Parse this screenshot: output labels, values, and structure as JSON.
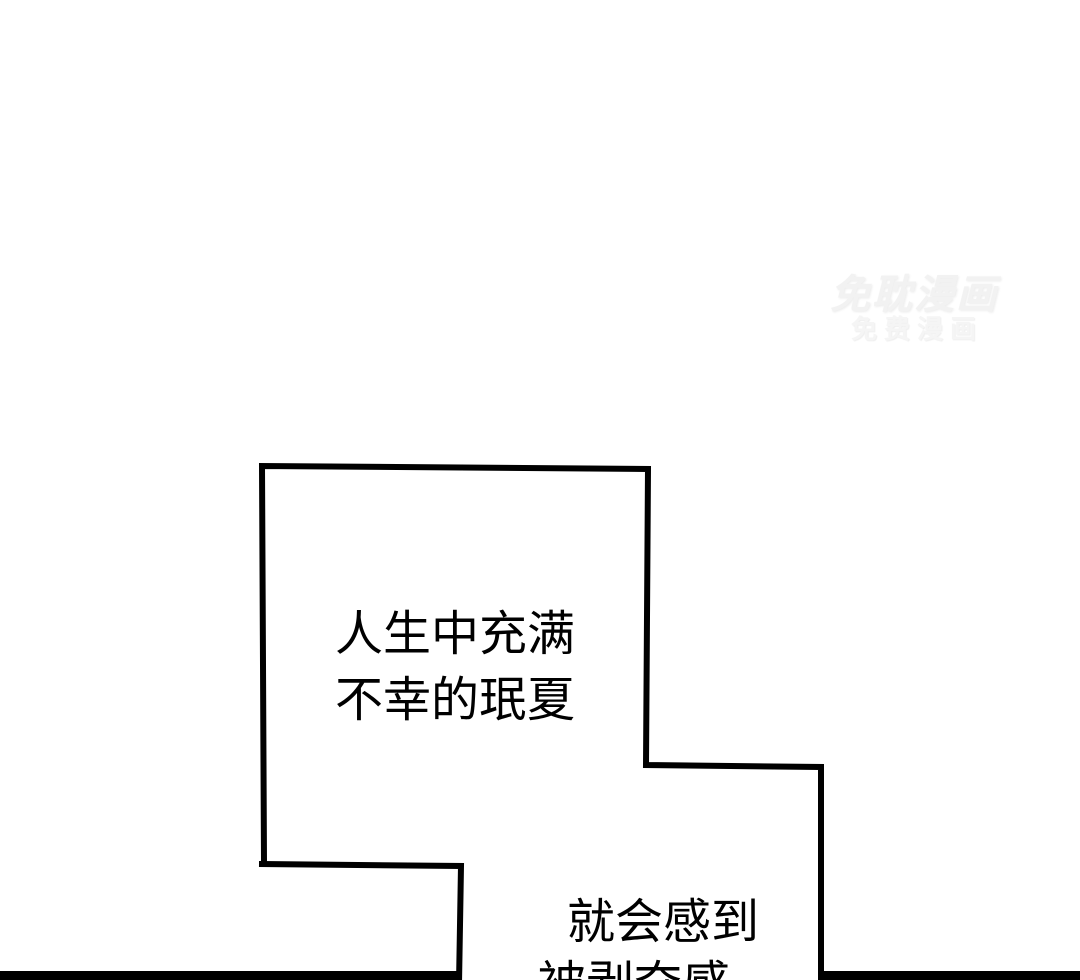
{
  "colors": {
    "ink": "#000000",
    "background": "#ffffff",
    "watermark_primary": "#f2f2f2",
    "watermark_secondary": "#f5f5f5"
  },
  "watermark": {
    "line1": "免耽漫画",
    "line2": "免费漫画"
  },
  "speech": {
    "panel1": {
      "line1": "人生中充满",
      "line2": "不幸的珉夏"
    },
    "panel2": {
      "line1": "就会感到",
      "line2": "被剥夺感"
    }
  }
}
